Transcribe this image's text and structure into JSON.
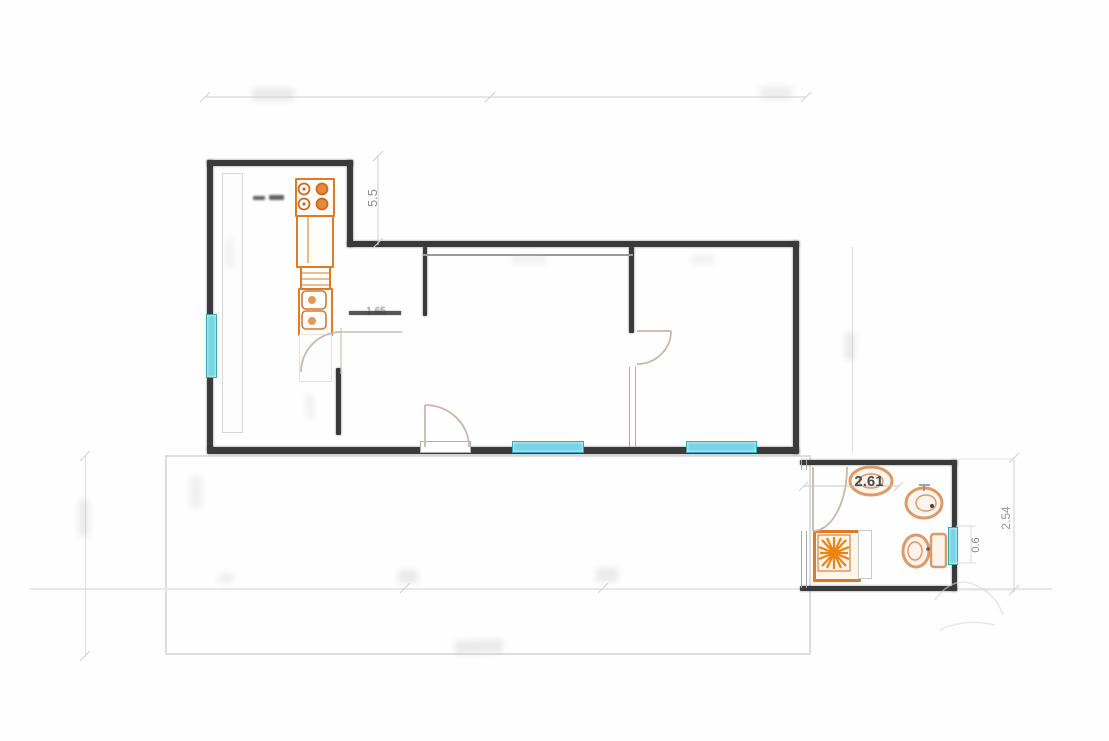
{
  "drawing": {
    "type": "apartment-floor-plan",
    "dimension_labels": {
      "kitchen_wall_height": "5.5",
      "bathroom_width": "2.61",
      "hall_width": "1.65",
      "right_side_height": "2.54",
      "bathroom_window_width": "0.6"
    },
    "colors": {
      "wall": "#3a3a3a",
      "fixture_orange": "#dd7b28",
      "burner_orange": "#e58a3c",
      "sunburst_orange": "#ec8413",
      "sanitary_stroke": "#d9854f",
      "window_teal": "#74d6e0",
      "window_teal_border": "#35aab6",
      "door_arc": "#c9b6ae",
      "dimension_line": "#d0d0d0",
      "dimension_text": "#8f8f8f",
      "dark_label_text": "#4a4a4a"
    },
    "icons": [
      "stove-burners-icon",
      "kitchen-sink-icon",
      "kitchen-cabinet-icon",
      "shower-sunburst-icon",
      "washbasin-icon",
      "bidet-icon",
      "toilet-icon",
      "door-arc-icon",
      "window-icon"
    ]
  }
}
